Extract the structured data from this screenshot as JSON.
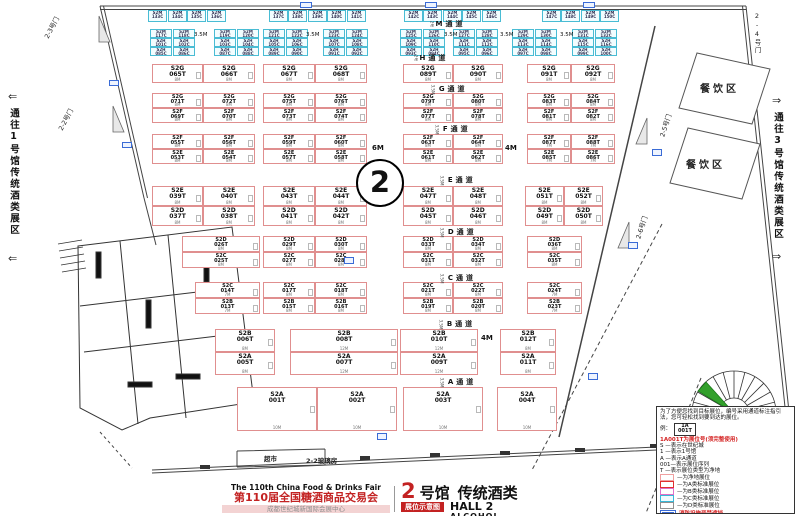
{
  "hall_badge": "2",
  "corridors": {
    "left": "通往1号馆传统酒类展区",
    "right": "通往3号馆传统酒类展区",
    "left_arrow": "⇐",
    "right_arrow": "⇒"
  },
  "banner": {
    "fair_en": "The 110th China Food & Drinks Fair",
    "fair_cn": "第110届全国糖酒商品交易会",
    "venue": "成都世纪城新国际会展中心",
    "hall_num": "2",
    "hall_suffix": "号馆",
    "hall_type": "传统酒类",
    "plan_tag": "展位示意图",
    "hall_en": "HALL 2",
    "type_en": "ALCOHOL"
  },
  "legend": {
    "intro": "为了方便您找到目标展位，编号采用通道标注指引法，您可轻松找到要到达的展位。",
    "example_label": "例：",
    "example_line1": "1A",
    "example_line2": "001T",
    "code_note": "1A001T为展位号(须完整使用)",
    "items": [
      "S —表示在世纪城",
      "1 —表示1号馆",
      "A —表示A通道",
      "001—表示展位序列",
      "T —表示展位类型为净地"
    ],
    "swatches": [
      {
        "label": "—为净地展位",
        "border": "#f0a0a0",
        "fill": "#ffffff"
      },
      {
        "label": "—为A类标准展位",
        "border": "#e03030",
        "fill": "#ffffff"
      },
      {
        "label": "—为B类标准展位",
        "border": "#e070c8",
        "fill": "#ffffff"
      },
      {
        "label": "—为C类标准展位",
        "border": "#38b8d8",
        "fill": "#f0fcff"
      },
      {
        "label": "—为D类标准展位",
        "border": "#909090",
        "fill": "#ffffff"
      }
    ],
    "fire_note": "消防设施严禁遮挡"
  },
  "doors": [
    {
      "label": "2-3号门",
      "x": 50,
      "y": 30,
      "rot": -62,
      "v": false
    },
    {
      "label": "2-2号门",
      "x": 64,
      "y": 122,
      "rot": -62,
      "v": false
    },
    {
      "label": "2-4号门",
      "x": 752,
      "y": 12,
      "rot": 0,
      "v": true
    },
    {
      "label": "2-5号门",
      "x": 666,
      "y": 128,
      "rot": -72,
      "v": false
    },
    {
      "label": "2-6号门",
      "x": 642,
      "y": 230,
      "rot": -72,
      "v": false
    }
  ],
  "areas": [
    {
      "label": "餐饮区",
      "x": 700,
      "y": 80,
      "small": false
    },
    {
      "label": "餐饮区",
      "x": 686,
      "y": 156,
      "small": false
    },
    {
      "label": "超市",
      "x": 264,
      "y": 453,
      "small": true
    },
    {
      "label": "2-2玻璃房",
      "x": 306,
      "y": 455,
      "small": true
    }
  ],
  "aisles": [
    {
      "label": "M通道",
      "pre": "2号",
      "x": 428,
      "y": 19
    },
    {
      "label": "H通道",
      "pre": "2号",
      "x": 412,
      "y": 53
    },
    {
      "label": "G通道",
      "pre": "3.5M",
      "x": 428,
      "y": 84
    },
    {
      "label": "F通道",
      "pre": "3.5M",
      "x": 432,
      "y": 124
    },
    {
      "label": "E通道",
      "pre": "3.5M",
      "x": 437,
      "y": 175
    },
    {
      "label": "D通道",
      "pre": "3.5M",
      "x": 437,
      "y": 227
    },
    {
      "label": "C通道",
      "pre": "3.5M",
      "x": 437,
      "y": 273
    },
    {
      "label": "B通道",
      "pre": "3.5M",
      "x": 436,
      "y": 319
    },
    {
      "label": "A通道",
      "pre": "3.5M",
      "x": 437,
      "y": 377
    }
  ],
  "gap_labels": [
    {
      "text": "3.5M",
      "x": 194,
      "y": 32,
      "small": true
    },
    {
      "text": "3.5M",
      "x": 306,
      "y": 32,
      "small": true
    },
    {
      "text": "3.5M",
      "x": 444,
      "y": 32,
      "small": true
    },
    {
      "text": "3.5M",
      "x": 500,
      "y": 32,
      "small": true
    },
    {
      "text": "3.5M",
      "x": 560,
      "y": 32,
      "small": true
    },
    {
      "text": "6M",
      "x": 372,
      "y": 144,
      "small": false
    },
    {
      "text": "4M",
      "x": 505,
      "y": 144,
      "small": false
    },
    {
      "text": "4M",
      "x": 481,
      "y": 334,
      "small": false
    }
  ],
  "booth_format": "[code, number, x, y, w, h, width_label]",
  "booths": [
    [
      "S2G",
      "065T",
      152,
      64,
      51,
      19,
      "8M"
    ],
    [
      "S2G",
      "066T",
      203,
      64,
      52,
      19,
      "8M"
    ],
    [
      "S2G",
      "067T",
      263,
      64,
      52,
      19,
      "8M"
    ],
    [
      "S2G",
      "068T",
      315,
      64,
      52,
      19,
      "8M"
    ],
    [
      "S2G",
      "089T",
      403,
      64,
      50,
      19,
      "8M"
    ],
    [
      "S2G",
      "090T",
      453,
      64,
      50,
      19,
      "8M"
    ],
    [
      "S2G",
      "091T",
      527,
      64,
      44,
      19,
      "8M"
    ],
    [
      "S2G",
      "092T",
      571,
      64,
      44,
      19,
      "8M"
    ],
    [
      "S2G",
      "071T",
      152,
      93,
      51,
      15,
      "8M"
    ],
    [
      "S2G",
      "072T",
      203,
      93,
      52,
      15,
      "8M"
    ],
    [
      "S2G",
      "075T",
      263,
      93,
      52,
      15,
      "8M"
    ],
    [
      "S2G",
      "076T",
      315,
      93,
      52,
      15,
      "8M"
    ],
    [
      "S2G",
      "079T",
      403,
      93,
      50,
      15,
      "8M"
    ],
    [
      "S2G",
      "080T",
      453,
      93,
      50,
      15,
      "8M"
    ],
    [
      "S2G",
      "083T",
      527,
      93,
      44,
      15,
      "8M"
    ],
    [
      "S2G",
      "084T",
      571,
      93,
      44,
      15,
      "8M"
    ],
    [
      "S2F",
      "069T",
      152,
      108,
      51,
      15,
      "8M"
    ],
    [
      "S2F",
      "070T",
      203,
      108,
      52,
      15,
      "8M"
    ],
    [
      "S2F",
      "073T",
      263,
      108,
      52,
      15,
      "8M"
    ],
    [
      "S2F",
      "074T",
      315,
      108,
      52,
      15,
      "8M"
    ],
    [
      "S2F",
      "077T",
      403,
      108,
      50,
      15,
      "8M"
    ],
    [
      "S2F",
      "078T",
      453,
      108,
      50,
      15,
      "8M"
    ],
    [
      "S2F",
      "081T",
      527,
      108,
      44,
      15,
      "8M"
    ],
    [
      "S2F",
      "082T",
      571,
      108,
      44,
      15,
      "8M"
    ],
    [
      "S2F",
      "055T",
      152,
      134,
      51,
      15,
      "8M"
    ],
    [
      "S2F",
      "056T",
      203,
      134,
      52,
      15,
      "8M"
    ],
    [
      "S2F",
      "059T",
      263,
      134,
      52,
      15,
      "8M"
    ],
    [
      "S2F",
      "060T",
      315,
      134,
      52,
      15,
      "8M"
    ],
    [
      "S2F",
      "063T",
      403,
      134,
      50,
      15,
      "8M"
    ],
    [
      "S2F",
      "064T",
      453,
      134,
      50,
      15,
      "8M"
    ],
    [
      "S2F",
      "087T",
      527,
      134,
      44,
      15,
      "7M"
    ],
    [
      "S2F",
      "088T",
      571,
      134,
      44,
      15,
      "7M"
    ],
    [
      "S2E",
      "053T",
      152,
      149,
      51,
      15,
      "8M"
    ],
    [
      "S2E",
      "054T",
      203,
      149,
      52,
      15,
      "8M"
    ],
    [
      "S2E",
      "057T",
      263,
      149,
      52,
      15,
      "8M"
    ],
    [
      "S2E",
      "058T",
      315,
      149,
      52,
      15,
      "8M"
    ],
    [
      "S2E",
      "061T",
      403,
      149,
      50,
      15,
      "8M"
    ],
    [
      "S2E",
      "062T",
      453,
      149,
      50,
      15,
      "8M"
    ],
    [
      "S2E",
      "085T",
      527,
      149,
      44,
      15,
      "7M"
    ],
    [
      "S2E",
      "086T",
      571,
      149,
      44,
      15,
      "7M"
    ],
    [
      "S2E",
      "039T",
      152,
      186,
      51,
      20,
      "8M"
    ],
    [
      "S2E",
      "040T",
      203,
      186,
      52,
      20,
      "8M"
    ],
    [
      "S2E",
      "043T",
      263,
      186,
      52,
      20,
      "8M"
    ],
    [
      "S2E",
      "044T",
      315,
      186,
      52,
      20,
      "8M"
    ],
    [
      "S2E",
      "047T",
      403,
      186,
      50,
      20,
      "8M"
    ],
    [
      "S2E",
      "048T",
      453,
      186,
      50,
      20,
      "8M"
    ],
    [
      "S2E",
      "051T",
      525,
      186,
      39,
      20,
      "8M"
    ],
    [
      "S2E",
      "052T",
      564,
      186,
      39,
      20,
      "8M"
    ],
    [
      "S2D",
      "037T",
      152,
      206,
      51,
      20,
      "8M"
    ],
    [
      "S2D",
      "038T",
      203,
      206,
      52,
      20,
      "8M"
    ],
    [
      "S2D",
      "041T",
      263,
      206,
      52,
      20,
      "8M"
    ],
    [
      "S2D",
      "042T",
      315,
      206,
      52,
      20,
      "8M"
    ],
    [
      "S2D",
      "045T",
      403,
      206,
      50,
      20,
      "8M"
    ],
    [
      "S2D",
      "046T",
      453,
      206,
      50,
      20,
      "8M"
    ],
    [
      "S2D",
      "049T",
      525,
      206,
      39,
      20,
      "8M"
    ],
    [
      "S2D",
      "050T",
      564,
      206,
      39,
      20,
      "8M"
    ],
    [
      "S2D",
      "026T",
      182,
      236,
      78,
      16,
      "8M"
    ],
    [
      "S2D",
      "029T",
      263,
      236,
      52,
      16,
      "8M"
    ],
    [
      "S2D",
      "030T",
      315,
      236,
      52,
      16,
      "8M"
    ],
    [
      "S2D",
      "033T",
      403,
      236,
      50,
      16,
      "8M"
    ],
    [
      "S2D",
      "034T",
      453,
      236,
      50,
      16,
      "8M"
    ],
    [
      "S2D",
      "036T",
      527,
      236,
      55,
      16,
      "8M"
    ],
    [
      "S2C",
      "025T",
      182,
      252,
      78,
      16,
      "8M"
    ],
    [
      "S2C",
      "027T",
      263,
      252,
      52,
      16,
      "8M"
    ],
    [
      "S2C",
      "028T",
      315,
      252,
      52,
      16,
      "8M"
    ],
    [
      "S2C",
      "031T",
      403,
      252,
      50,
      16,
      "8M"
    ],
    [
      "S2C",
      "032T",
      453,
      252,
      50,
      16,
      "8M"
    ],
    [
      "S2C",
      "035T",
      527,
      252,
      55,
      16,
      "8M"
    ],
    [
      "S2C",
      "014T",
      195,
      282,
      65,
      16,
      "7M"
    ],
    [
      "S2C",
      "017T",
      263,
      282,
      52,
      16,
      "8M"
    ],
    [
      "S2C",
      "018T",
      315,
      282,
      52,
      16,
      "8M"
    ],
    [
      "S2C",
      "021T",
      403,
      282,
      50,
      16,
      "8M"
    ],
    [
      "S2C",
      "022T",
      453,
      282,
      50,
      16,
      "8M"
    ],
    [
      "S2C",
      "024T",
      527,
      282,
      55,
      16,
      "7M"
    ],
    [
      "S2B",
      "013T",
      195,
      298,
      65,
      16,
      "7M"
    ],
    [
      "S2B",
      "015T",
      263,
      298,
      52,
      16,
      "8M"
    ],
    [
      "S2B",
      "016T",
      315,
      298,
      52,
      16,
      "8M"
    ],
    [
      "S2B",
      "019T",
      403,
      298,
      50,
      16,
      "8M"
    ],
    [
      "S2B",
      "020T",
      453,
      298,
      50,
      16,
      "8M"
    ],
    [
      "S2B",
      "023T",
      527,
      298,
      55,
      16,
      "7M"
    ],
    [
      "S2B",
      "006T",
      215,
      329,
      60,
      23,
      "8M"
    ],
    [
      "S2B",
      "008T",
      290,
      329,
      108,
      23,
      "12M"
    ],
    [
      "S2B",
      "010T",
      400,
      329,
      78,
      23,
      "12M"
    ],
    [
      "S2B",
      "012T",
      500,
      329,
      56,
      23,
      "8M"
    ],
    [
      "S2A",
      "005T",
      215,
      352,
      60,
      23,
      "8M"
    ],
    [
      "S2A",
      "007T",
      290,
      352,
      108,
      23,
      "12M"
    ],
    [
      "S2A",
      "009T",
      400,
      352,
      78,
      23,
      "12M"
    ],
    [
      "S2A",
      "011T",
      500,
      352,
      56,
      23,
      "8M"
    ],
    [
      "S2A",
      "001T",
      237,
      387,
      80,
      44,
      "10M"
    ],
    [
      "S2A",
      "002T",
      317,
      387,
      80,
      44,
      "10M"
    ],
    [
      "S2A",
      "003T",
      403,
      387,
      80,
      44,
      "10M"
    ],
    [
      "S2A",
      "004T",
      497,
      387,
      60,
      44,
      "10M"
    ]
  ],
  "small_booth_format": "[code, number, x, y, w, h]",
  "small_booths": [
    [
      "S2M",
      "133C",
      148,
      10,
      19,
      12
    ],
    [
      "S2M",
      "134C",
      168,
      10,
      19,
      12
    ],
    [
      "S2M",
      "135C",
      187,
      10,
      19,
      12
    ],
    [
      "S2M",
      "136C",
      207,
      10,
      19,
      12
    ],
    [
      "S2M",
      "137C",
      269,
      10,
      19,
      12
    ],
    [
      "S2M",
      "138C",
      288,
      10,
      19,
      12
    ],
    [
      "S2M",
      "139C",
      308,
      10,
      19,
      12
    ],
    [
      "S2M",
      "140C",
      327,
      10,
      19,
      12
    ],
    [
      "S2M",
      "141C",
      347,
      10,
      19,
      12
    ],
    [
      "S2M",
      "142C",
      404,
      10,
      19,
      12
    ],
    [
      "S2M",
      "143C",
      423,
      10,
      19,
      12
    ],
    [
      "S2M",
      "144C",
      443,
      10,
      19,
      12
    ],
    [
      "S2M",
      "145C",
      462,
      10,
      19,
      12
    ],
    [
      "S2M",
      "146C",
      482,
      10,
      19,
      12
    ],
    [
      "S2M",
      "147C",
      542,
      10,
      19,
      12
    ],
    [
      "S2M",
      "148C",
      561,
      10,
      19,
      12
    ],
    [
      "S2M",
      "149C",
      581,
      10,
      19,
      12
    ],
    [
      "S2M",
      "150C",
      600,
      10,
      19,
      12
    ],
    [
      "S2M",
      "117C",
      150,
      29,
      22,
      9
    ],
    [
      "S2M",
      "118C",
      173,
      29,
      22,
      9
    ],
    [
      "S2M",
      "119C",
      214,
      29,
      22,
      9
    ],
    [
      "S2M",
      "120C",
      237,
      29,
      22,
      9
    ],
    [
      "S2M",
      "121C",
      263,
      29,
      22,
      9
    ],
    [
      "S2M",
      "122C",
      286,
      29,
      22,
      9
    ],
    [
      "S2M",
      "123C",
      323,
      29,
      22,
      9
    ],
    [
      "S2M",
      "124C",
      346,
      29,
      22,
      9
    ],
    [
      "S2M",
      "125C",
      400,
      29,
      22,
      9
    ],
    [
      "S2M",
      "126C",
      423,
      29,
      22,
      9
    ],
    [
      "S2M",
      "127C",
      453,
      29,
      22,
      9
    ],
    [
      "S2M",
      "128C",
      476,
      29,
      22,
      9
    ],
    [
      "S2M",
      "129C",
      512,
      29,
      22,
      9
    ],
    [
      "S2M",
      "130C",
      535,
      29,
      22,
      9
    ],
    [
      "S2M",
      "131C",
      572,
      29,
      22,
      9
    ],
    [
      "S2M",
      "132C",
      595,
      29,
      22,
      9
    ],
    [
      "S2H",
      "101C",
      150,
      38,
      22,
      9
    ],
    [
      "S2H",
      "102C",
      173,
      38,
      22,
      9
    ],
    [
      "S2H",
      "103C",
      214,
      38,
      22,
      9
    ],
    [
      "S2H",
      "104C",
      237,
      38,
      22,
      9
    ],
    [
      "S2H",
      "105C",
      263,
      38,
      22,
      9
    ],
    [
      "S2H",
      "106C",
      286,
      38,
      22,
      9
    ],
    [
      "S2H",
      "107C",
      323,
      38,
      22,
      9
    ],
    [
      "S2H",
      "108C",
      346,
      38,
      22,
      9
    ],
    [
      "S2H",
      "109C",
      400,
      38,
      22,
      9
    ],
    [
      "S2H",
      "110C",
      423,
      38,
      22,
      9
    ],
    [
      "S2H",
      "111C",
      453,
      38,
      22,
      9
    ],
    [
      "S2H",
      "112C",
      476,
      38,
      22,
      9
    ],
    [
      "S2H",
      "113C",
      512,
      38,
      22,
      9
    ],
    [
      "S2H",
      "114C",
      535,
      38,
      22,
      9
    ],
    [
      "S2H",
      "115C",
      572,
      38,
      22,
      9
    ],
    [
      "S2H",
      "116C",
      595,
      38,
      22,
      9
    ],
    [
      "S2H",
      "085C",
      150,
      47,
      22,
      9
    ],
    [
      "S2H",
      "086C",
      173,
      47,
      22,
      9
    ],
    [
      "S2H",
      "087C",
      214,
      47,
      22,
      9
    ],
    [
      "S2H",
      "088C",
      237,
      47,
      22,
      9
    ],
    [
      "S2H",
      "089C",
      263,
      47,
      22,
      9
    ],
    [
      "S2H",
      "090C",
      286,
      47,
      22,
      9
    ],
    [
      "S2H",
      "091C",
      323,
      47,
      22,
      9
    ],
    [
      "S2H",
      "092C",
      346,
      47,
      22,
      9
    ],
    [
      "S2H",
      "093C",
      400,
      47,
      22,
      9
    ],
    [
      "S2H",
      "094C",
      423,
      47,
      22,
      9
    ],
    [
      "S2H",
      "095C",
      453,
      47,
      22,
      9
    ],
    [
      "S2H",
      "096C",
      476,
      47,
      22,
      9
    ],
    [
      "S2H",
      "097C",
      512,
      47,
      22,
      9
    ],
    [
      "S2H",
      "098C",
      535,
      47,
      22,
      9
    ],
    [
      "S2H",
      "099C",
      572,
      47,
      22,
      9
    ],
    [
      "S2H",
      "100C",
      595,
      47,
      22,
      9
    ]
  ],
  "fire_markers": [
    [
      300,
      2,
      12,
      6
    ],
    [
      425,
      2,
      12,
      6
    ],
    [
      583,
      2,
      12,
      6
    ],
    [
      109,
      80,
      10,
      6
    ],
    [
      122,
      142,
      10,
      6
    ],
    [
      344,
      257,
      10,
      7
    ],
    [
      377,
      433,
      10,
      7
    ],
    [
      652,
      149,
      10,
      7
    ],
    [
      628,
      242,
      10,
      7
    ],
    [
      588,
      373,
      10,
      7
    ]
  ]
}
